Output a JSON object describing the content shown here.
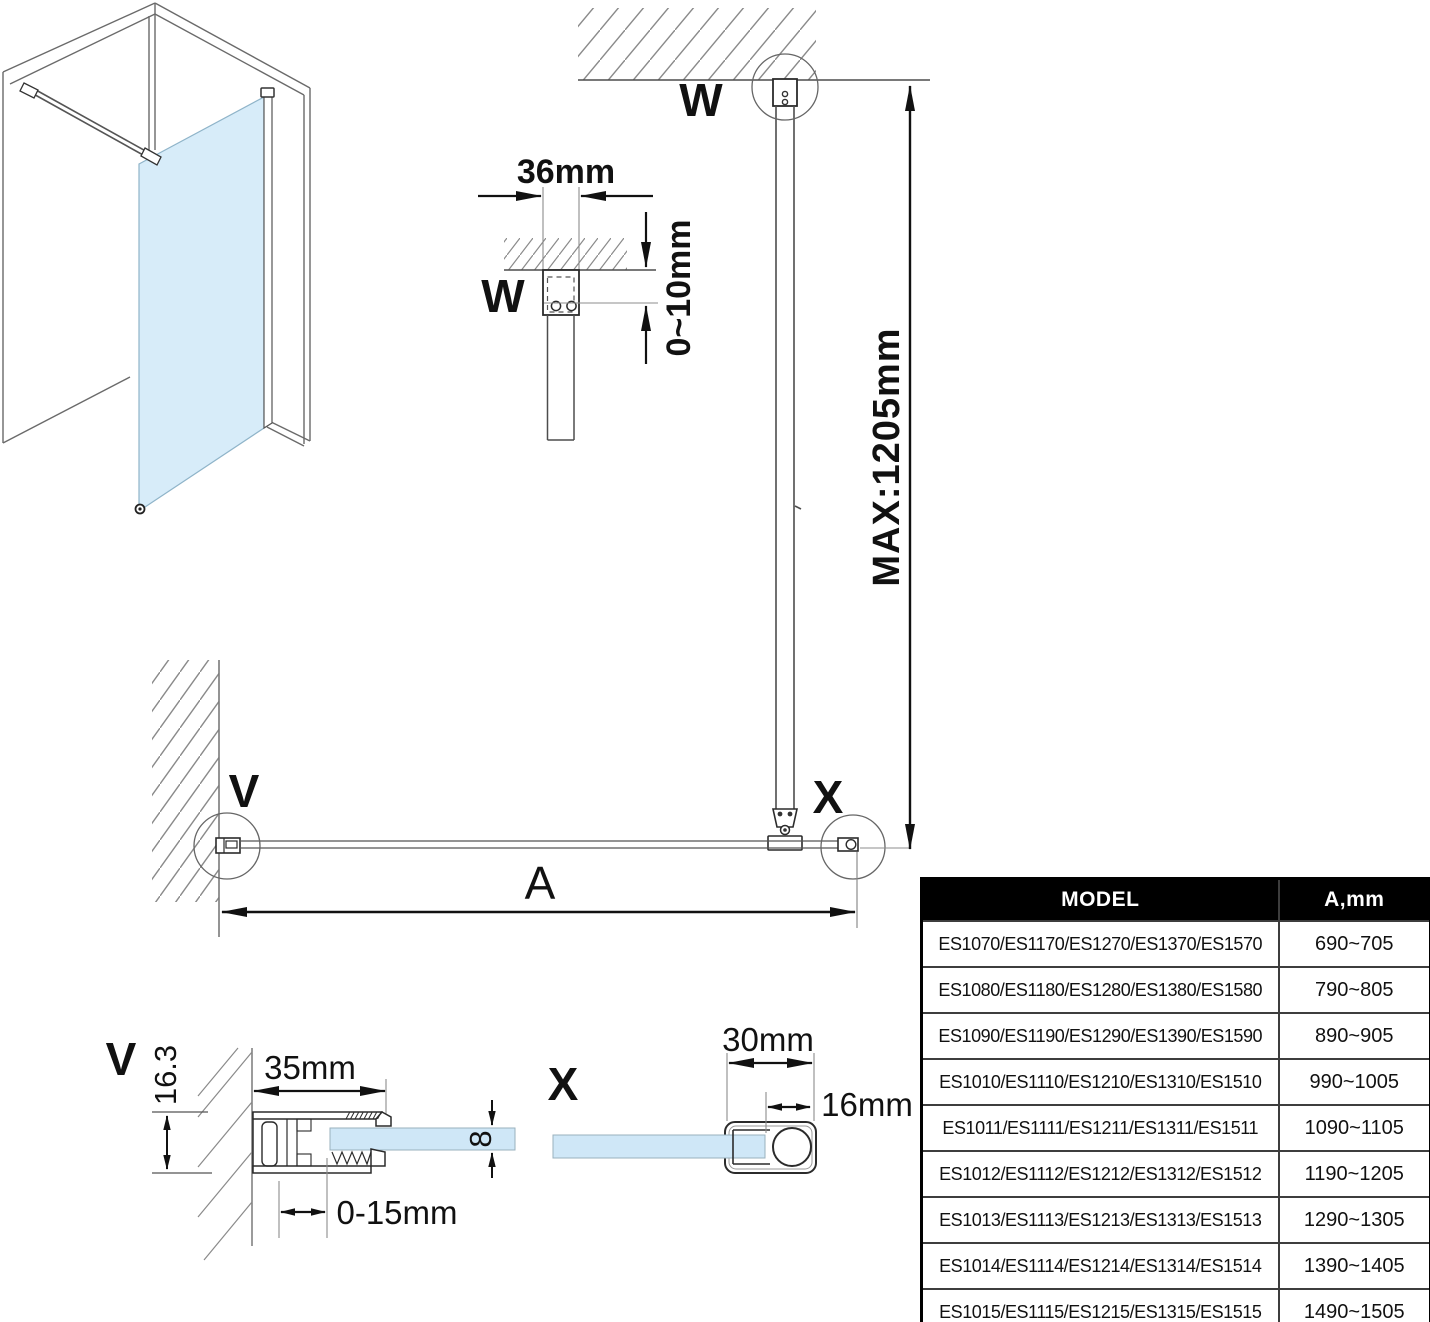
{
  "labels": {
    "wDetail": {
      "label": "W",
      "width": "36mm",
      "gap": "0~10mm"
    },
    "main": {
      "topLabel": "W",
      "wallLabel": "V",
      "barLabel": "X",
      "span": "A",
      "height": "MAX:1205mm"
    },
    "vDetail": {
      "label": "V",
      "profileHeight": "16.3",
      "profileWidth": "35mm",
      "glassThickness": "8",
      "adjustRange": "0-15mm"
    },
    "xDetail": {
      "label": "X",
      "profileWidth": "30mm",
      "barWidth": "16mm"
    }
  },
  "table": {
    "headers": [
      "MODEL",
      "A,mm"
    ],
    "rows": [
      {
        "model": "ES1070/ES1170/ES1270/ES1370/ES1570",
        "a": "690~705"
      },
      {
        "model": "ES1080/ES1180/ES1280/ES1380/ES1580",
        "a": "790~805"
      },
      {
        "model": "ES1090/ES1190/ES1290/ES1390/ES1590",
        "a": "890~905"
      },
      {
        "model": "ES1010/ES1110/ES1210/ES1310/ES1510",
        "a": "990~1005"
      },
      {
        "model": "ES1011/ES1111/ES1211/ES1311/ES1511",
        "a": "1090~1105"
      },
      {
        "model": "ES1012/ES1112/ES1212/ES1312/ES1512",
        "a": "1190~1205"
      },
      {
        "model": "ES1013/ES1113/ES1213/ES1313/ES1513",
        "a": "1290~1305"
      },
      {
        "model": "ES1014/ES1114/ES1214/ES1314/ES1514",
        "a": "1390~1405"
      },
      {
        "model": "ES1015/ES1115/ES1215/ES1315/ES1515",
        "a": "1490~1505"
      }
    ]
  },
  "colors": {
    "glass": "#d7ecf9",
    "glassEdge": "#8fb4c9",
    "line": "#4d4d4d",
    "dim": "#111111",
    "hatch": "#8a8a8a",
    "tableHeaderBg": "#000000",
    "tableHeaderText": "#ffffff"
  }
}
